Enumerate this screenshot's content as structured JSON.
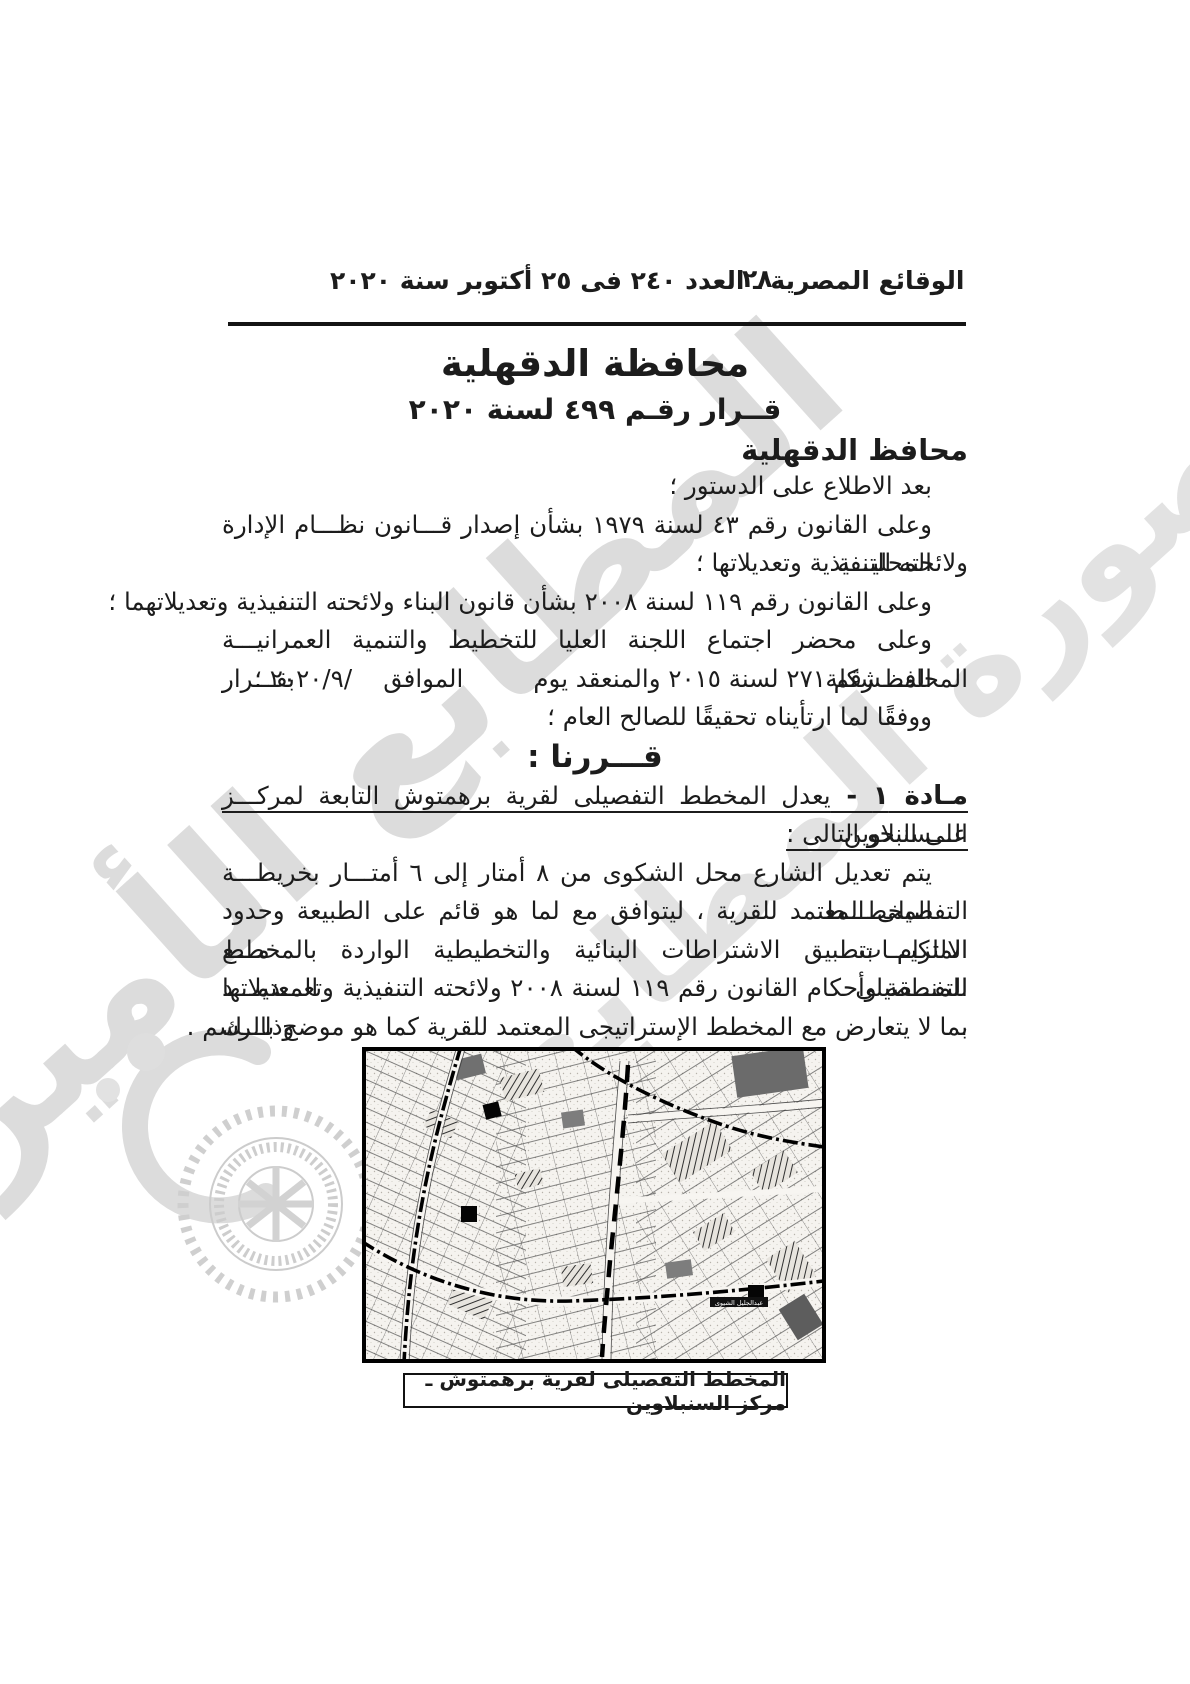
{
  "page": {
    "header": {
      "page_number": "٢٨",
      "issue_line": "الوقائع المصرية ـ العدد ٢٤٠ فى ٢٥ أكتوبر سنة ٢٠٢٠"
    },
    "titles": {
      "governorate": "محافظة الدقهلية",
      "decree": "قــرار رقـم ٤٩٩ لسنة ٢٠٢٠",
      "issuer": "محافظ الدقهلية"
    },
    "preamble": {
      "line1": "بعد الاطلاع على الدستور ؛",
      "line2": "وعلى القانون رقم ٤٣ لسنة ١٩٧٩ بشأن إصدار قـــانون نظـــام الإدارة المحليـــة",
      "line3": "ولائحته التنفيذية وتعديلاتها ؛",
      "line4": "وعلى القانون رقم ١١٩ لسنة ٢٠٠٨ بشأن قانون البناء ولائحته التنفيذية وتعديلاتهما ؛",
      "line5": "وعلى محضر اجتماع اللجنة العليا للتخطيط والتنمية العمرانيـــة المـــشكلة بقـــرار",
      "line6_a": "المحافظ رقم ٢٧١ لسنة ٢٠١٥ والمنعقد يوم         الموافق    ",
      "line6_date": "٢٠٢٠/٩/",
      "line6_b": " ؛",
      "line7": "ووفقًا لما ارتأيناه تحقيقًا للصالح العام ؛"
    },
    "decision_heading": "قـــررنا :",
    "article1": {
      "label": "مـادة ١ - ",
      "title_line1": "يعدل المخطط التفصيلى لقرية برهمتوش التابعة لمركـــز الـــسنبلاوين",
      "title_line2": "على النحو التالى :",
      "body1": "يتم تعديل الشارع محل الشكوى من ٨ أمتار إلى ٦ أمتـــار بخريطـــة المخطـــط",
      "body2": "التفصيلى المعتمد للقرية ، ليتوافق مع لما هو قائم على الطبيعة وحدود الملكيـــات مـــع",
      "body3": "الالتزام بتطبيق الاشتراطات البنائية والتخطيطية الواردة بالمخطط التفـــصيلى المعتمـــد",
      "body4": "للمنطقة وأحكام القانون رقم ١١٩ لسنة ٢٠٠٨ ولائحته التنفيذية وتعـــديلاتها ، وذلـــك",
      "body5": "بما لا يتعارض مع المخطط الإستراتيجى المعتمد للقرية كما هو موضح بالرسم ."
    },
    "map": {
      "inline_label": "عبدالجليل الشيوى",
      "caption": "المخطط التفصيلى لقرية برهمتوش ـ مركز السنبلاوين"
    },
    "watermark": {
      "band1": "المطابع الأميرية",
      "band2": "صورة المطابع"
    },
    "colors": {
      "ink": "#1c1c1c",
      "watermark_gray": "#d7d7d7",
      "paper": "#ffffff"
    }
  }
}
